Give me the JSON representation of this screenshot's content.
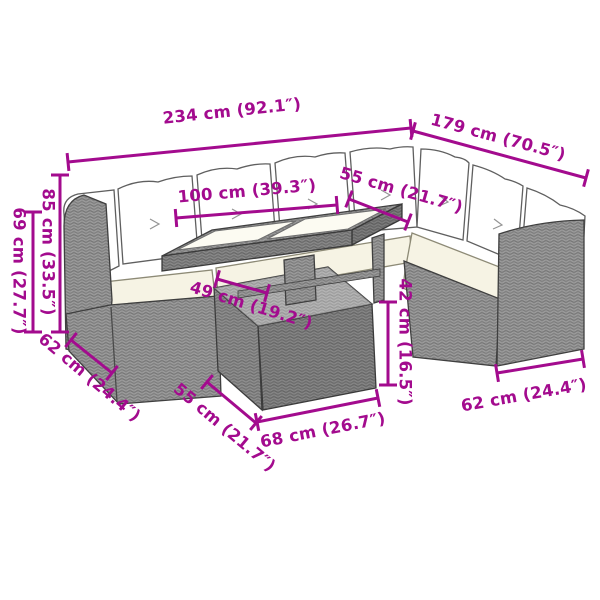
{
  "diagram": {
    "accent_color": "#a30b8e",
    "background_color": "#ffffff",
    "rattan_color": "#9b9b9b",
    "rattan_weave_color": "#6f6f6f",
    "cushion_color": "#ffffff",
    "seat_cushion_color": "#f6f3e4",
    "outline_color": "#3f3f3f"
  },
  "dimensions": [
    {
      "id": "total-width",
      "label": "234 cm (92.1″)",
      "line": [
        68,
        162,
        411,
        128
      ],
      "text": [
        232,
        112
      ],
      "rot": -6
    },
    {
      "id": "total-depth",
      "label": "179 cm (70.5″)",
      "line": [
        413,
        131,
        586,
        178
      ],
      "text": [
        498,
        138
      ],
      "rot": 15
    },
    {
      "id": "tabletop-width",
      "label": "100 cm (39.3″)",
      "line": [
        176,
        218,
        337,
        205
      ],
      "text": [
        247,
        192
      ],
      "rot": -5
    },
    {
      "id": "seat-depth-top",
      "label": "55 cm (21.7″)",
      "line": [
        349,
        199,
        408,
        222
      ],
      "text": [
        401,
        191
      ],
      "rot": 16
    },
    {
      "id": "back-height",
      "label": "85 cm (33.5″)",
      "line": [
        60,
        175,
        60,
        332
      ],
      "text": [
        47,
        252
      ],
      "rot": 90
    },
    {
      "id": "arm-height",
      "label": "69 cm (27.7″)",
      "line": [
        33,
        212,
        33,
        332
      ],
      "text": [
        18,
        271
      ],
      "rot": 90
    },
    {
      "id": "tabletop-depth",
      "label": "49 cm (19.2″)",
      "line": [
        217,
        279,
        267,
        293
      ],
      "text": [
        251,
        306
      ],
      "rot": 17
    },
    {
      "id": "table-base-height",
      "label": "42 cm (16.5″)",
      "line": [
        388,
        302,
        388,
        385
      ],
      "text": [
        404,
        342
      ],
      "rot": 90
    },
    {
      "id": "sofa-depth-left",
      "label": "62 cm (24.4″)",
      "line": [
        71,
        340,
        112,
        373
      ],
      "text": [
        89,
        378
      ],
      "rot": 40
    },
    {
      "id": "table-base-depth",
      "label": "55 cm (21.7″)",
      "line": [
        207,
        382,
        256,
        423
      ],
      "text": [
        224,
        428
      ],
      "rot": 40
    },
    {
      "id": "table-base-width",
      "label": "68 cm (26.7″)",
      "line": [
        257,
        422,
        378,
        398
      ],
      "text": [
        323,
        431
      ],
      "rot": -11
    },
    {
      "id": "sofa-depth-right",
      "label": "62 cm (24.4″)",
      "line": [
        497,
        373,
        583,
        359
      ],
      "text": [
        524,
        396
      ],
      "rot": -10
    }
  ]
}
